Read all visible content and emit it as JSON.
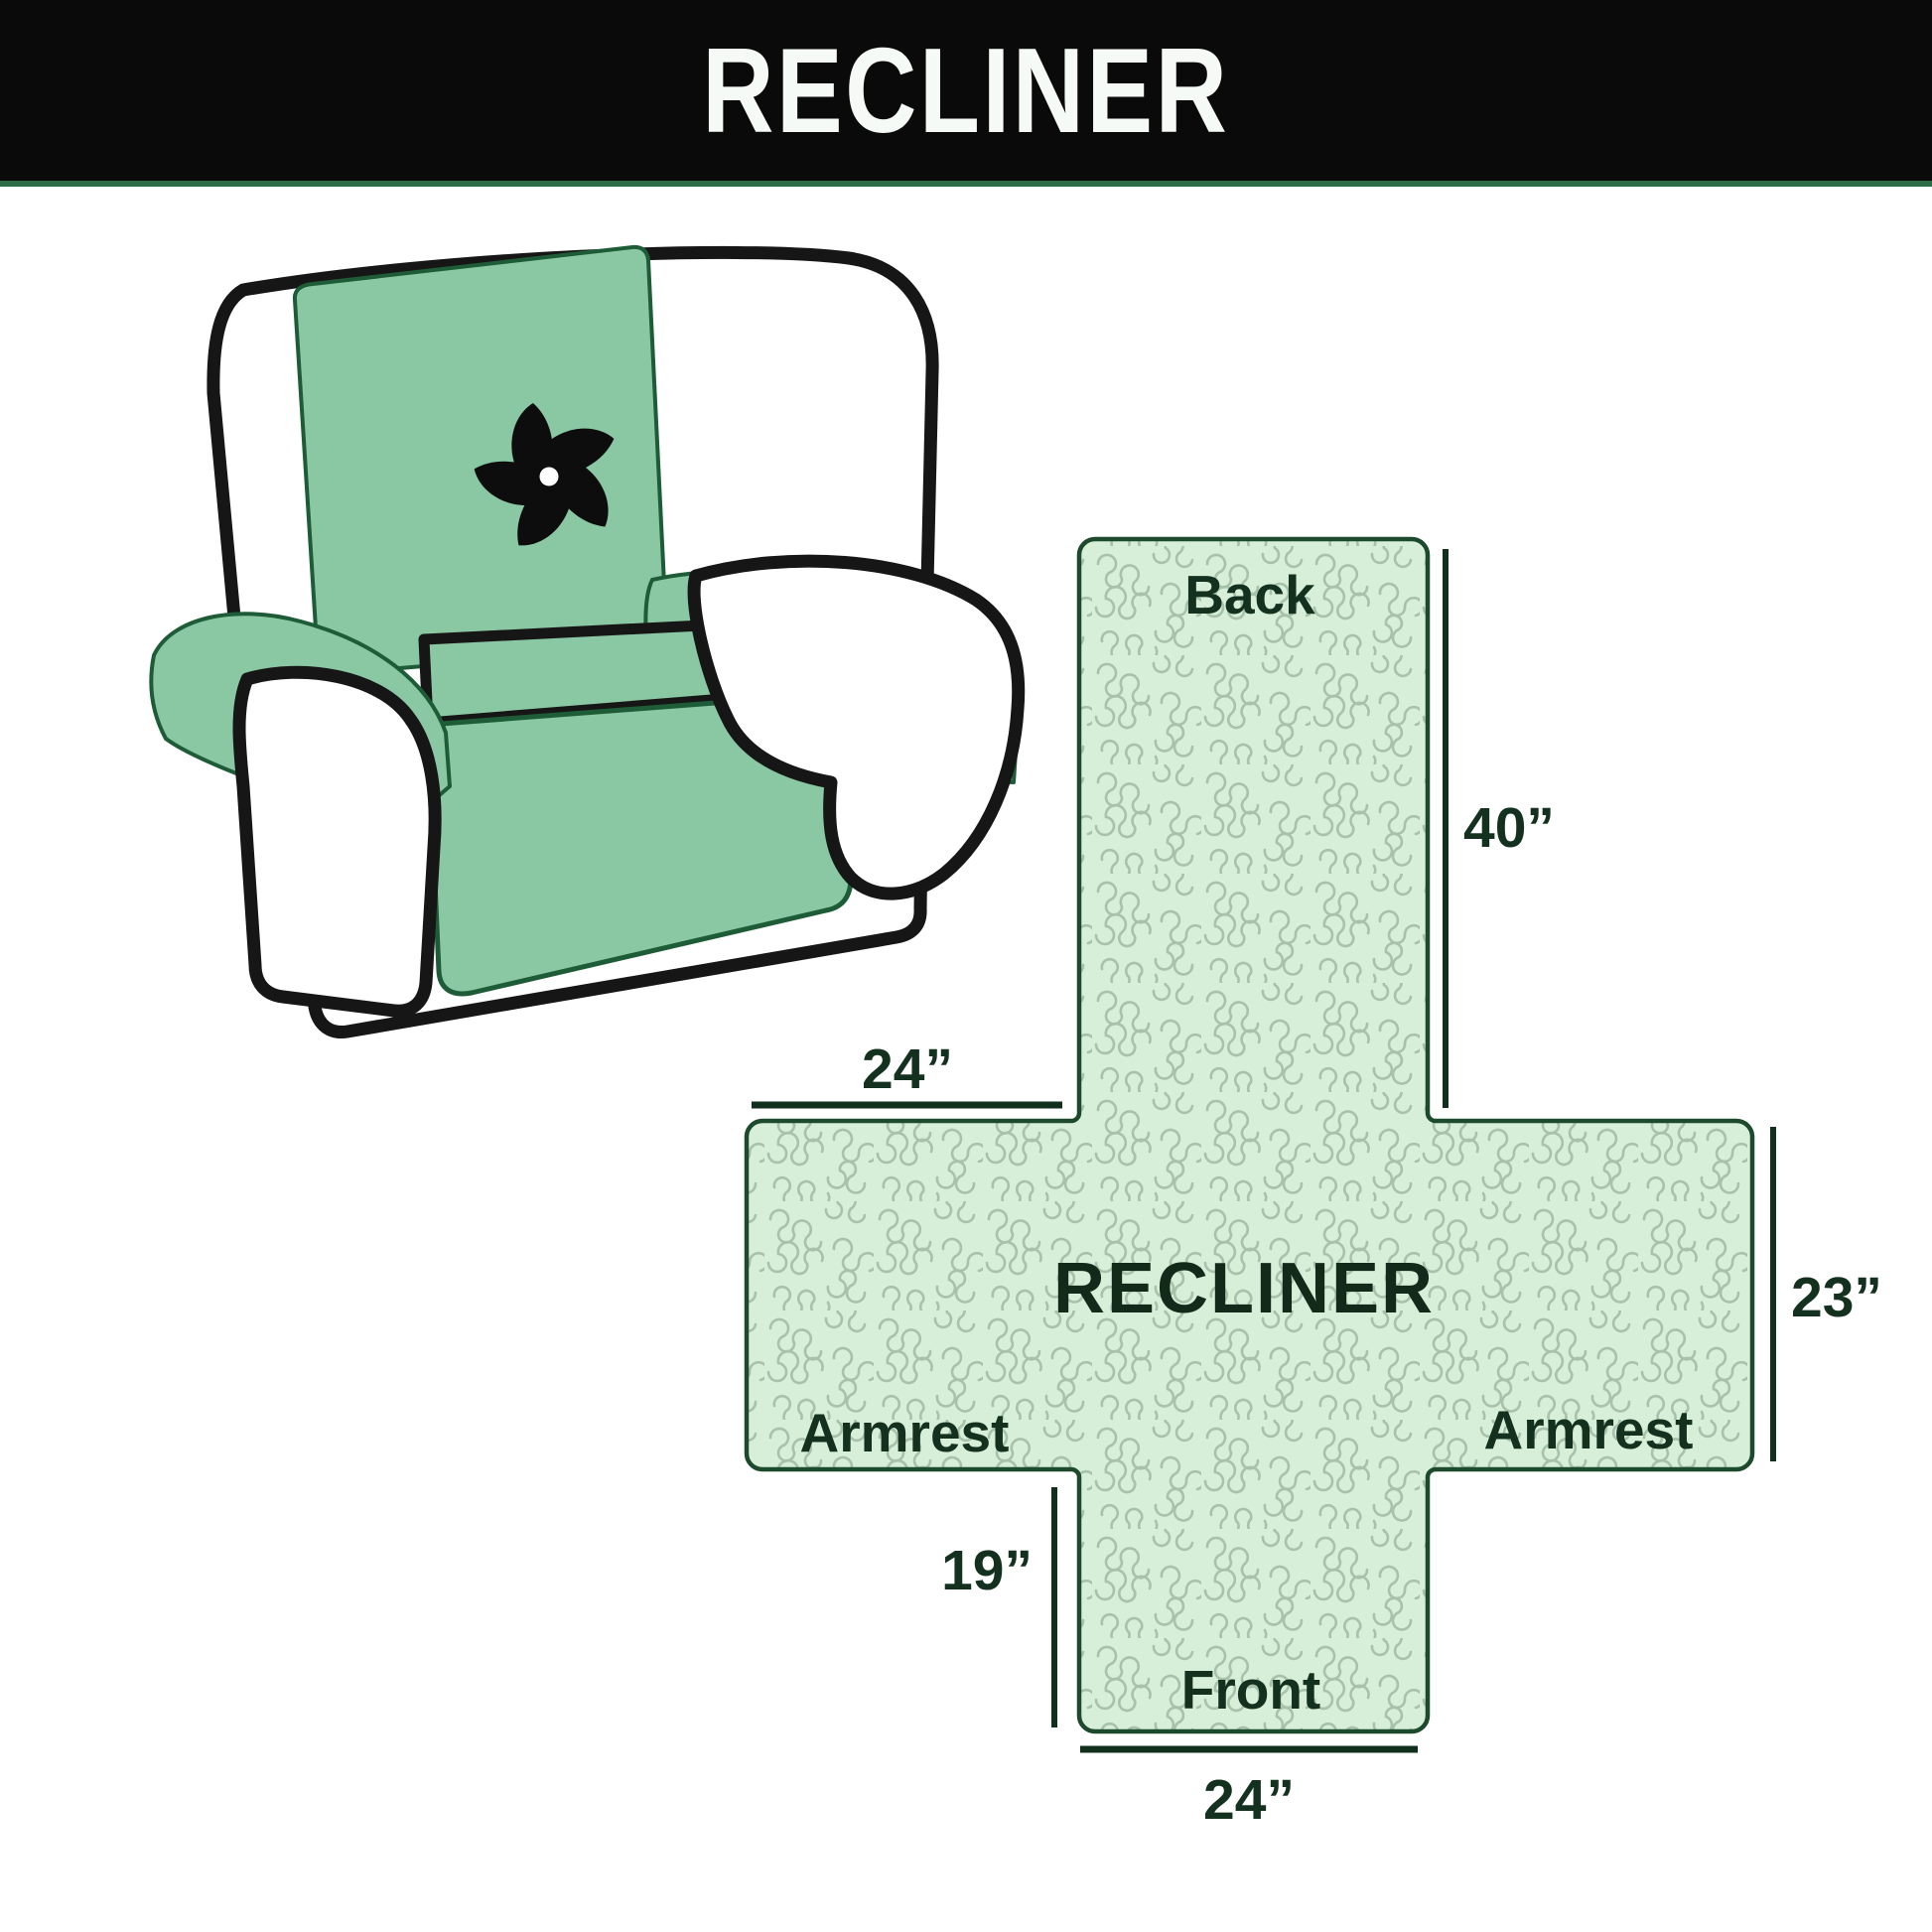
{
  "header": {
    "title": "RECLINER"
  },
  "diagram": {
    "center_label": "RECLINER",
    "panels": {
      "back": "Back",
      "front": "Front",
      "armrest_left": "Armrest",
      "armrest_right": "Armrest"
    },
    "dimensions": {
      "back_height": "40”",
      "armrest_top_width": "24”",
      "armrest_side_height": "23”",
      "front_side_height": "19”",
      "front_bottom_width": "24”"
    }
  },
  "illustration": {
    "icon": "pinwheel-fan-icon"
  },
  "colors": {
    "header_bg": "#0a0a0a",
    "header_text": "#f5faf6",
    "header_accent_line": "#2e6b47",
    "cover_green": "#8ac7a3",
    "cover_seam_green": "#1e5c38",
    "layout_fill": "#d7eed8",
    "layout_pattern": "#a7c1ab",
    "layout_border": "#1d4a2c",
    "label_text": "#14311f",
    "outline_black": "#161616"
  }
}
